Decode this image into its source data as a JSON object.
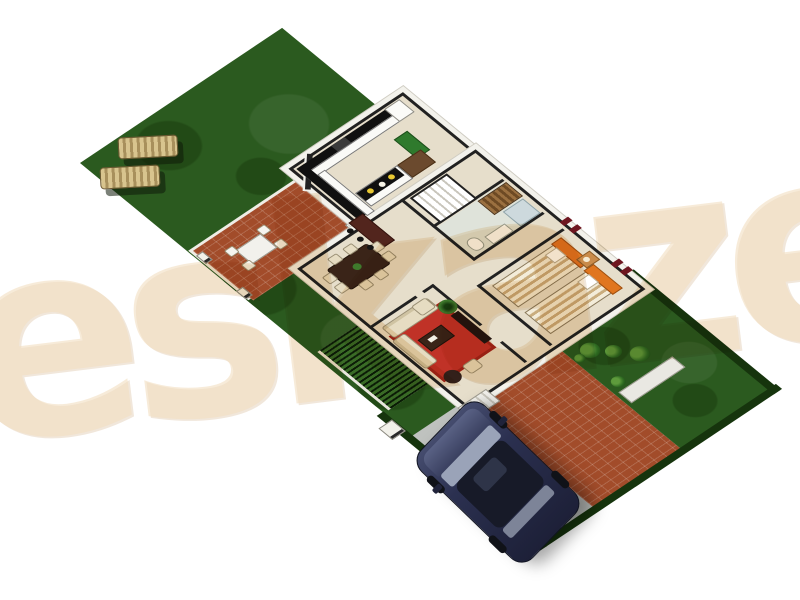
{
  "scene": {
    "title": "3D isometric floor plan render of a single-storey house plot",
    "watermark": {
      "text": "eskaze"
    },
    "plot": {
      "areas": [
        "main-lawn",
        "outdoor-patio",
        "garden-hedge-strip",
        "left-lawn",
        "driveway",
        "front-brick-path",
        "front-lawn"
      ],
      "outdoor_items": [
        "sun-lounger",
        "sun-lounger",
        "outdoor-dining-set",
        "lamp-posts",
        "gate-posts",
        "planter-box",
        "shrubs",
        "parked-suv"
      ]
    },
    "house": {
      "rooms": [
        {
          "name": "kitchen",
          "items": [
            "l-shaped-counter",
            "stove",
            "refrigerator",
            "island-with-bowls",
            "green-door",
            "breakfast-bench"
          ]
        },
        {
          "name": "staircase",
          "items": [
            "stair-treads"
          ]
        },
        {
          "name": "dining-room",
          "items": [
            "dining-table",
            "dining-chairs",
            "bar-counter",
            "bar-stools"
          ]
        },
        {
          "name": "living-room",
          "items": [
            "corner-sofa",
            "armchair",
            "coffee-table",
            "red-rug",
            "tv-console",
            "round-ottoman",
            "palm-plant"
          ]
        },
        {
          "name": "bathroom",
          "items": [
            "toilet",
            "sink",
            "shower"
          ]
        },
        {
          "name": "wardrobe",
          "items": [
            "slatted-wardrobe"
          ]
        },
        {
          "name": "bedroom",
          "items": [
            "twin-bed",
            "twin-bed",
            "nightstand",
            "table-lamp",
            "wall-art"
          ]
        },
        {
          "name": "hallway",
          "items": []
        },
        {
          "name": "entrance-porch",
          "items": [
            "steps"
          ]
        }
      ]
    }
  },
  "colors": {
    "lawn": "#2b5a1f",
    "lawn-dark": "#224a16",
    "hedge": "#16340d",
    "brick": "#a24c2a",
    "driveway": "#bfc2bf",
    "floor": "#e6decb",
    "wall": "#212121",
    "trim": "#f3f2ec",
    "counter": "#101010",
    "bar": "#52251d",
    "wood": "#3a2418",
    "cream": "#e6dcc2",
    "rug": "#c03227",
    "headboard": "#e0761f",
    "bedstripe1": "#f3ecd9",
    "bedstripe2": "#c9ad7e",
    "car-body": "#2b3050",
    "car-roof": "#171a28",
    "glass": "#9aa3b8",
    "lounger1": "#d8c48e",
    "lounger2": "#a8905c",
    "green-door": "#2f7a2d",
    "bath-floor": "#dfe3da",
    "shrub": "#2f6b22",
    "watermark": "rgba(242,222,192,0.6)"
  }
}
